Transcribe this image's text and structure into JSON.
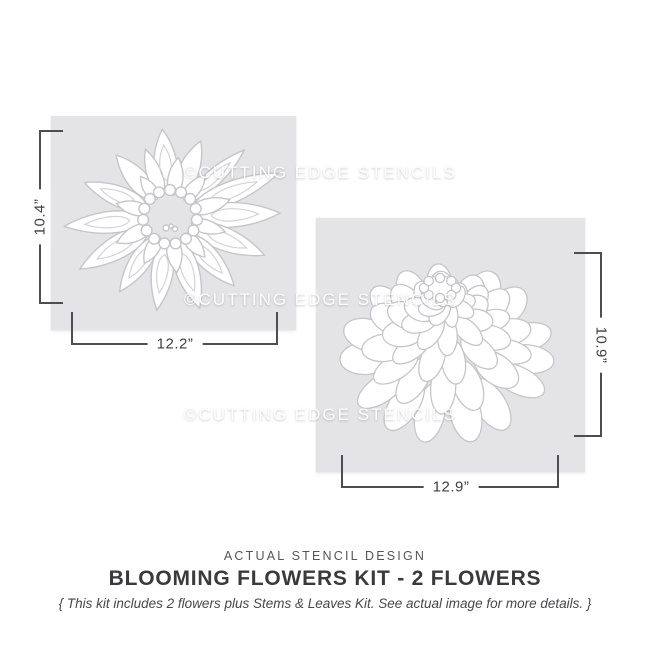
{
  "watermark": {
    "text": "©CUTTING EDGE STENCILS"
  },
  "stencils": [
    {
      "name": "anemone flower stencil",
      "height_label": "10.4”",
      "width_label": "12.2”"
    },
    {
      "name": "zinnia flower stencil",
      "height_label": "10.9”",
      "width_label": "12.9”"
    }
  ],
  "caption": {
    "kicker": "ACTUAL STENCIL DESIGN",
    "title": "BLOOMING FLOWERS KIT - 2 FLOWERS",
    "note": "{ This kit includes 2 flowers plus Stems & Leaves Kit. See actual image for more details. }"
  },
  "colors": {
    "stencil_gray": "#e4e4e6",
    "petal_outline": "#c6c6ca",
    "dimension_line": "#4e4e52",
    "title_text": "#3a3a3d"
  }
}
